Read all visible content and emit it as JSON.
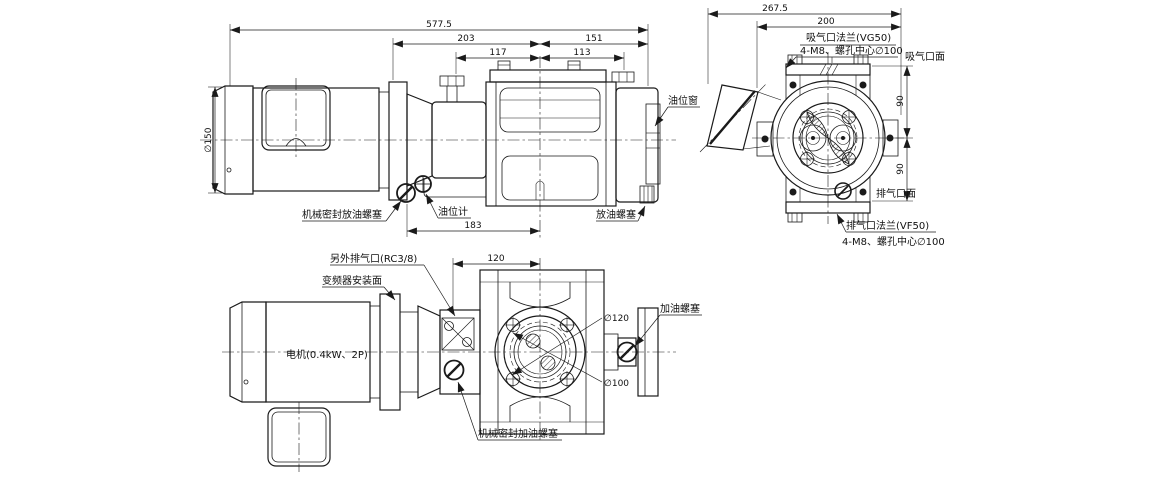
{
  "drawing_title": "pump-outline-drawing",
  "side_view": {
    "dims": {
      "overall": "577.5",
      "d203": "203",
      "d151": "151",
      "d117": "117",
      "d113": "113",
      "d183": "183",
      "motor_dia": "∅150"
    },
    "labels": {
      "oil_window": "油位窗",
      "mech_seal_drain": "机械密封放油螺塞",
      "oil_gauge": "油位计",
      "drain_plug": "放油螺塞"
    }
  },
  "end_view": {
    "dims": {
      "overall": "267.5",
      "d200": "200",
      "d90_upper": "90",
      "d90_lower": "90"
    },
    "labels": {
      "suction_flange": "吸气口法兰(VG50)",
      "suction_bolts": "4-M8、螺孔中心∅100",
      "suction_face": "吸气口面",
      "exhaust_face": "排气口面",
      "exhaust_flange": "排气口法兰(VF50)",
      "exhaust_bolts": "4-M8、螺孔中心∅100"
    }
  },
  "plan_view": {
    "dims": {
      "d120": "120",
      "dia120": "∅120",
      "dia100": "∅100"
    },
    "labels": {
      "aux_exhaust": "另外排气口(RC3/8)",
      "inverter_face": "变频器安装面",
      "motor": "电机(0.4kW、2P)",
      "mech_seal_fill": "机械密封加油螺塞",
      "fill_plug": "加油螺塞"
    }
  },
  "colors": {
    "line": "#1a1a1a",
    "background": "#ffffff"
  }
}
